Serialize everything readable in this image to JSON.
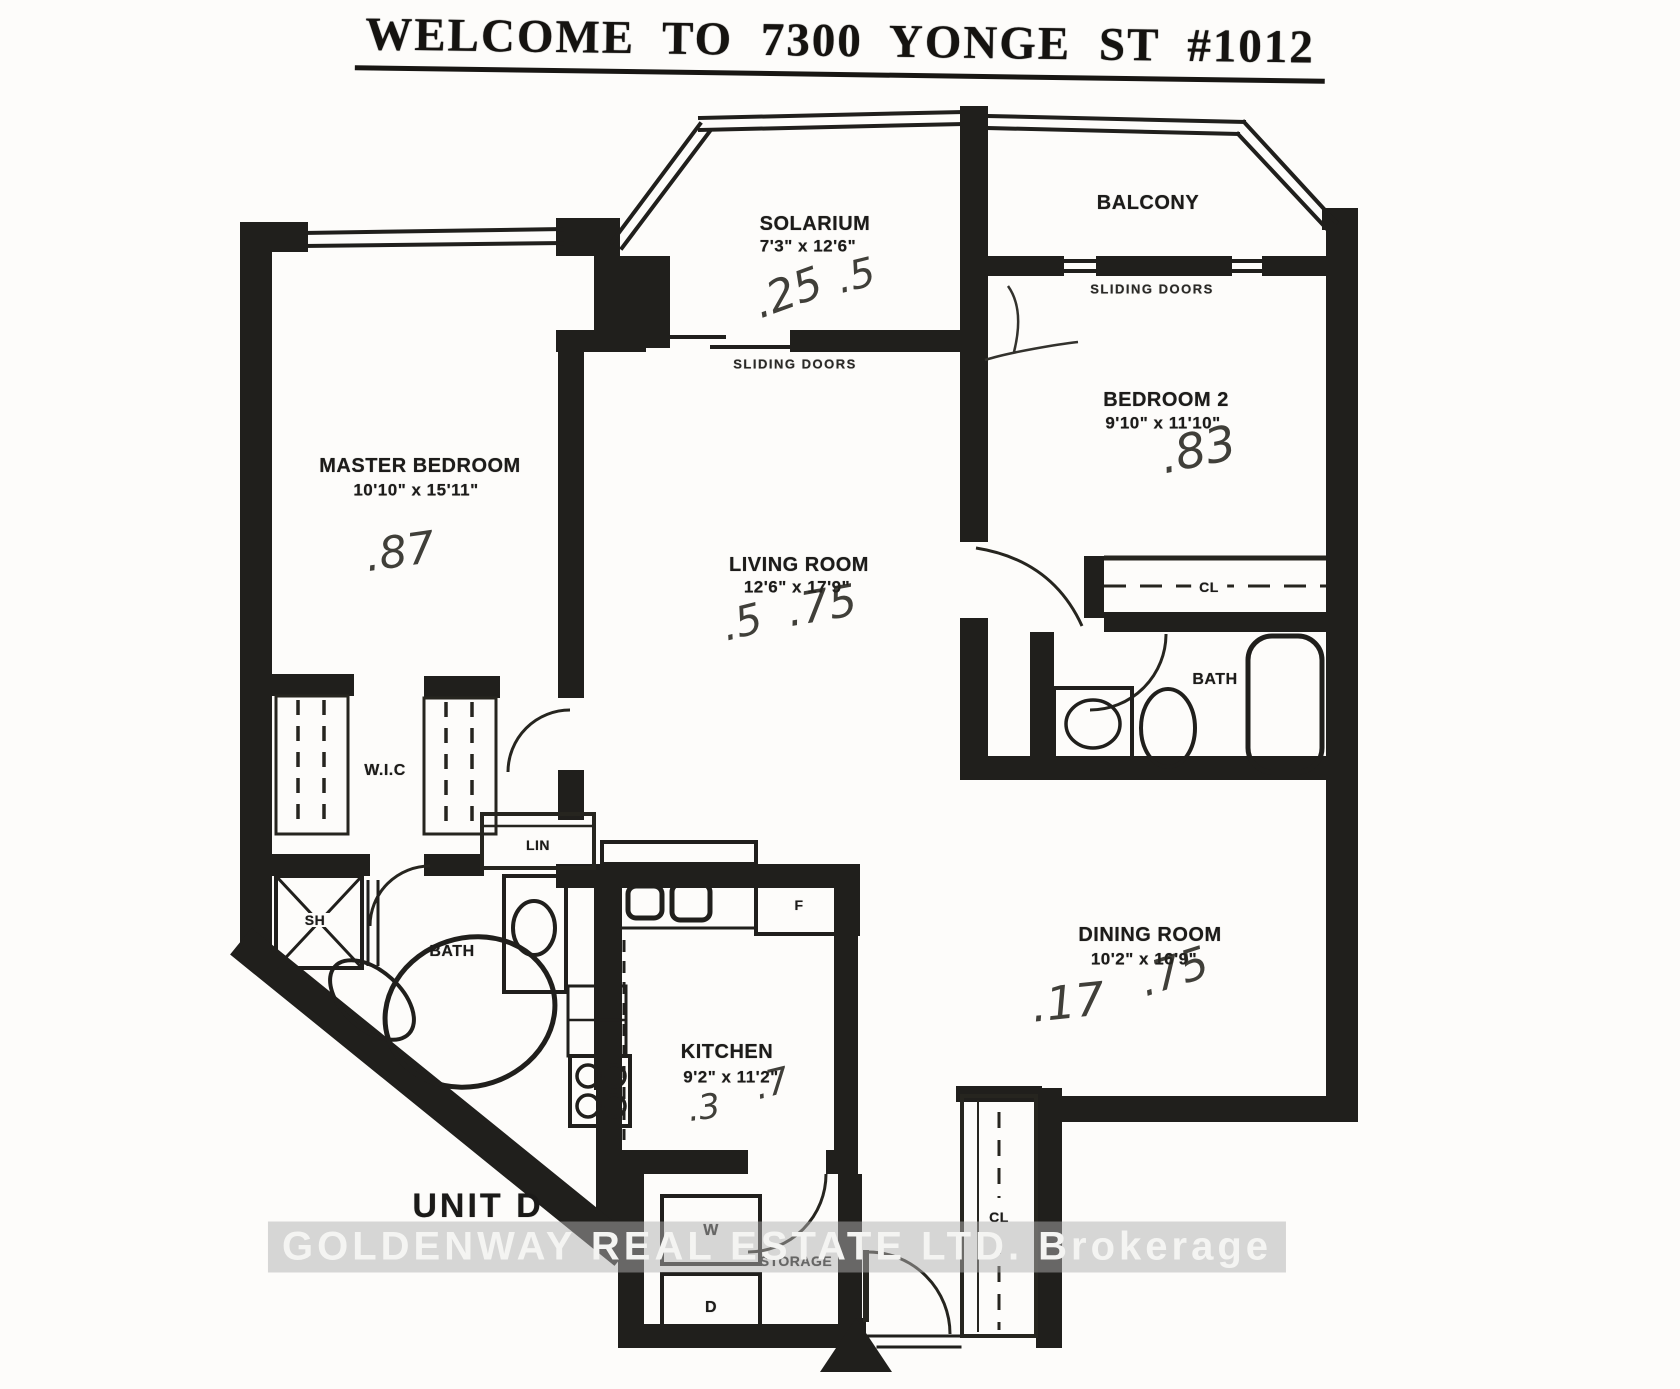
{
  "title": "WELCOME TO 7300 YONGE ST #1012",
  "unit_label": "UNIT D",
  "watermark": "GOLDENWAY REAL ESTATE LTD. Brokerage",
  "rooms": {
    "solarium": {
      "name": "SOLARIUM",
      "dims": "7'3\" x 12'6\""
    },
    "balcony": {
      "name": "BALCONY"
    },
    "master_bedroom": {
      "name": "MASTER BEDROOM",
      "dims": "10'10\" x 15'11\""
    },
    "bedroom_2": {
      "name": "BEDROOM 2",
      "dims": "9'10\" x 11'10\""
    },
    "living_room": {
      "name": "LIVING ROOM",
      "dims": "12'6\" x 17'9\""
    },
    "dining_room": {
      "name": "DINING ROOM",
      "dims": "10'2\" x 16'9\""
    },
    "kitchen": {
      "name": "KITCHEN",
      "dims": "9'2\" x 11'2\""
    }
  },
  "features": {
    "sliding_doors_solarium": "SLIDING DOORS",
    "sliding_doors_balcony": "SLIDING DOORS",
    "wic": "W.I.C",
    "closet_bedroom2": "CL",
    "bath_main": "BATH",
    "bath_ensuite": "BATH",
    "linen": "LIN",
    "shower": "SH",
    "fridge": "F",
    "washer": "W",
    "dryer": "D",
    "storage": "STORAGE",
    "closet_entry": "CL"
  },
  "annotations": {
    "handwritten_marks": [
      {
        "text": ".25"
      },
      {
        "text": ".5"
      },
      {
        "text": ".87"
      },
      {
        "text": ".83"
      },
      {
        "text": ".5"
      },
      {
        "text": ".75"
      },
      {
        "text": ".17"
      },
      {
        "text": ".75"
      },
      {
        "text": ".3"
      },
      {
        "text": ".7"
      }
    ]
  },
  "colors": {
    "ink": "#201f1c",
    "paper": "#fdfcfa",
    "watermark_band": "#b0b0b0",
    "watermark_text": "#f4f4f2"
  }
}
